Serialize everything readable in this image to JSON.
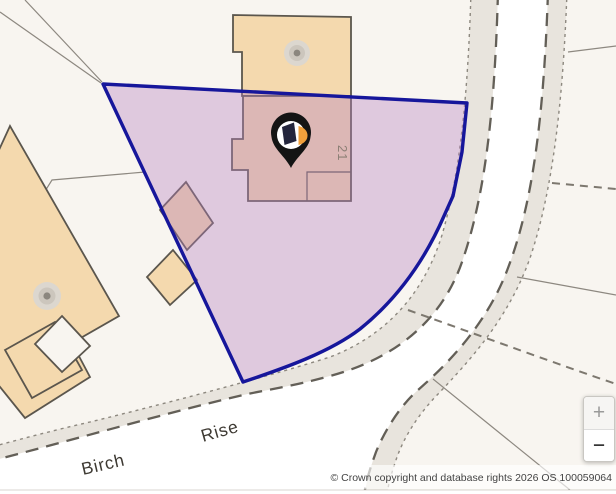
{
  "map": {
    "subject_property": {
      "house_number": "21",
      "marker": "property-pin"
    },
    "road_labels": [
      {
        "text": "Birch"
      },
      {
        "text": "Rise"
      }
    ],
    "attribution": "© Crown copyright and database rights 2026 OS 100059064",
    "zoom_control": {
      "zoom_in_label": "+",
      "zoom_out_label": "−"
    },
    "colors": {
      "background": "#f8f5f0",
      "road_surface": "#ffffff",
      "road_verge": "#e8e4dd",
      "building_fill": "#f4d9ae",
      "building_outline": "#5b564d",
      "boundary_line": "#16169b",
      "boundary_fill": "rgba(182,130,193,0.38)",
      "pin_body": "#141414",
      "pin_logo_dark": "#23253c",
      "pin_logo_orange": "#f0a03c"
    }
  }
}
